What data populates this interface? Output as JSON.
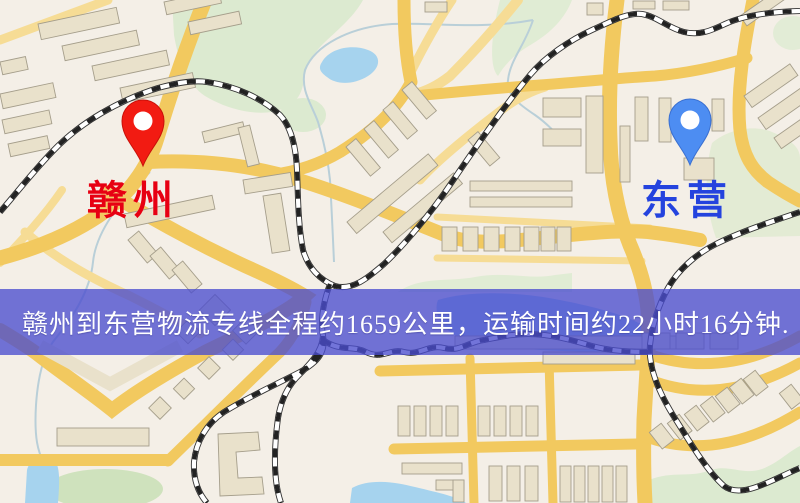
{
  "map": {
    "origin": {
      "label": "赣州",
      "label_color": "#e70012",
      "pin_icon": "red-map-pin",
      "pin_color": "#f21b12"
    },
    "destination": {
      "label": "东营",
      "label_color": "#2443de",
      "pin_icon": "blue-map-pin",
      "pin_color": "#4d8df2"
    },
    "legend_colors": {
      "road": "#f2c95f",
      "minor_road": "#f6dc95",
      "park_green": "#dcead0",
      "water_blue": "#a6d3ee",
      "building": "#e9e1cb",
      "railway": "#2b2b2b"
    }
  },
  "banner": {
    "text": "赣州到东营物流专线全程约1659公里，运输时间约22小时16分钟.",
    "bg_color": "#4a4dce",
    "text_color": "#ffffff",
    "distance_km": "1659",
    "duration": "22小时16分钟"
  }
}
